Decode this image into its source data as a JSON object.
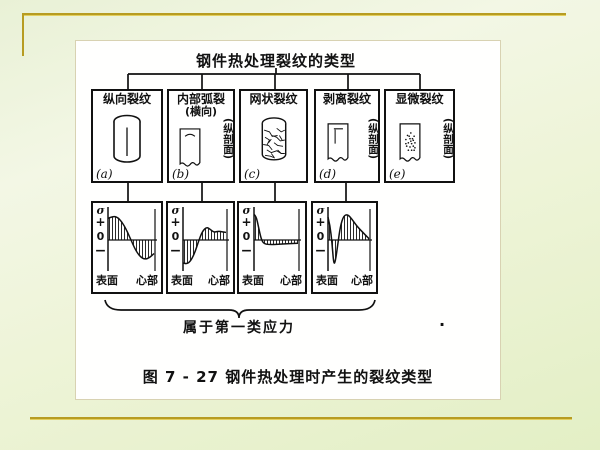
{
  "slide": {
    "accent_color": "#b79c22",
    "panel_bg": "#ffffff"
  },
  "figure": {
    "title": "钢件热处理裂纹的类型",
    "caption": "图 7 - 27  钢件热处理时产生的裂纹类型",
    "brace_label": "属于第一类应力",
    "stray_mark": ".",
    "axis": {
      "sigma": "σ",
      "plus": "+",
      "zero": "0",
      "minus": "−"
    },
    "xlabels": {
      "left": "表面",
      "right": "心部"
    },
    "types": [
      {
        "label": "纵向裂纹",
        "sublabel": "",
        "note": "",
        "letter": "(a)",
        "icon": "cylinder-longitudinal-crack"
      },
      {
        "label": "内部弧裂",
        "sublabel": "(横向)",
        "note": "(纵剖面)",
        "letter": "(b)",
        "icon": "section-arc-crack"
      },
      {
        "label": "网状裂纹",
        "sublabel": "",
        "note": "",
        "letter": "(c)",
        "icon": "cylinder-network-crack"
      },
      {
        "label": "剥离裂纹",
        "sublabel": "",
        "note": "(纵剖面)",
        "letter": "(d)",
        "icon": "section-peel-crack"
      },
      {
        "label": "显微裂纹",
        "sublabel": "",
        "note": "(纵剖面)",
        "letter": "(e)",
        "icon": "section-micro-cracks"
      }
    ],
    "stress_curves": [
      {
        "under": "(a)",
        "points": [
          [
            0,
            0.8
          ],
          [
            0.1,
            0.88
          ],
          [
            0.2,
            0.85
          ],
          [
            0.3,
            0.68
          ],
          [
            0.4,
            0.38
          ],
          [
            0.5,
            0.0
          ],
          [
            0.6,
            -0.38
          ],
          [
            0.7,
            -0.62
          ],
          [
            0.8,
            -0.72
          ],
          [
            0.9,
            -0.66
          ],
          [
            1,
            -0.5
          ]
        ]
      },
      {
        "under": "(b)",
        "points": [
          [
            0,
            -0.85
          ],
          [
            0.08,
            -0.9
          ],
          [
            0.18,
            -0.78
          ],
          [
            0.28,
            -0.45
          ],
          [
            0.36,
            -0.05
          ],
          [
            0.45,
            0.32
          ],
          [
            0.55,
            0.48
          ],
          [
            0.63,
            0.4
          ],
          [
            0.72,
            0.28
          ],
          [
            0.82,
            0.33
          ],
          [
            0.92,
            0.3
          ],
          [
            1,
            0.28
          ]
        ]
      },
      {
        "under": "(c)",
        "points": [
          [
            0,
            0.95
          ],
          [
            0.05,
            0.88
          ],
          [
            0.1,
            0.5
          ],
          [
            0.16,
            0.05
          ],
          [
            0.22,
            -0.14
          ],
          [
            0.35,
            -0.17
          ],
          [
            0.55,
            -0.16
          ],
          [
            0.75,
            -0.14
          ],
          [
            1,
            -0.12
          ]
        ]
      },
      {
        "under": "(d)",
        "points": [
          [
            0,
            0.85
          ],
          [
            0.05,
            0.55
          ],
          [
            0.1,
            -0.15
          ],
          [
            0.14,
            -0.9
          ],
          [
            0.18,
            -0.8
          ],
          [
            0.24,
            -0.15
          ],
          [
            0.3,
            0.5
          ],
          [
            0.38,
            0.9
          ],
          [
            0.48,
            0.95
          ],
          [
            0.58,
            0.78
          ],
          [
            0.7,
            0.52
          ],
          [
            0.85,
            0.28
          ],
          [
            1,
            0.05
          ]
        ]
      }
    ]
  }
}
